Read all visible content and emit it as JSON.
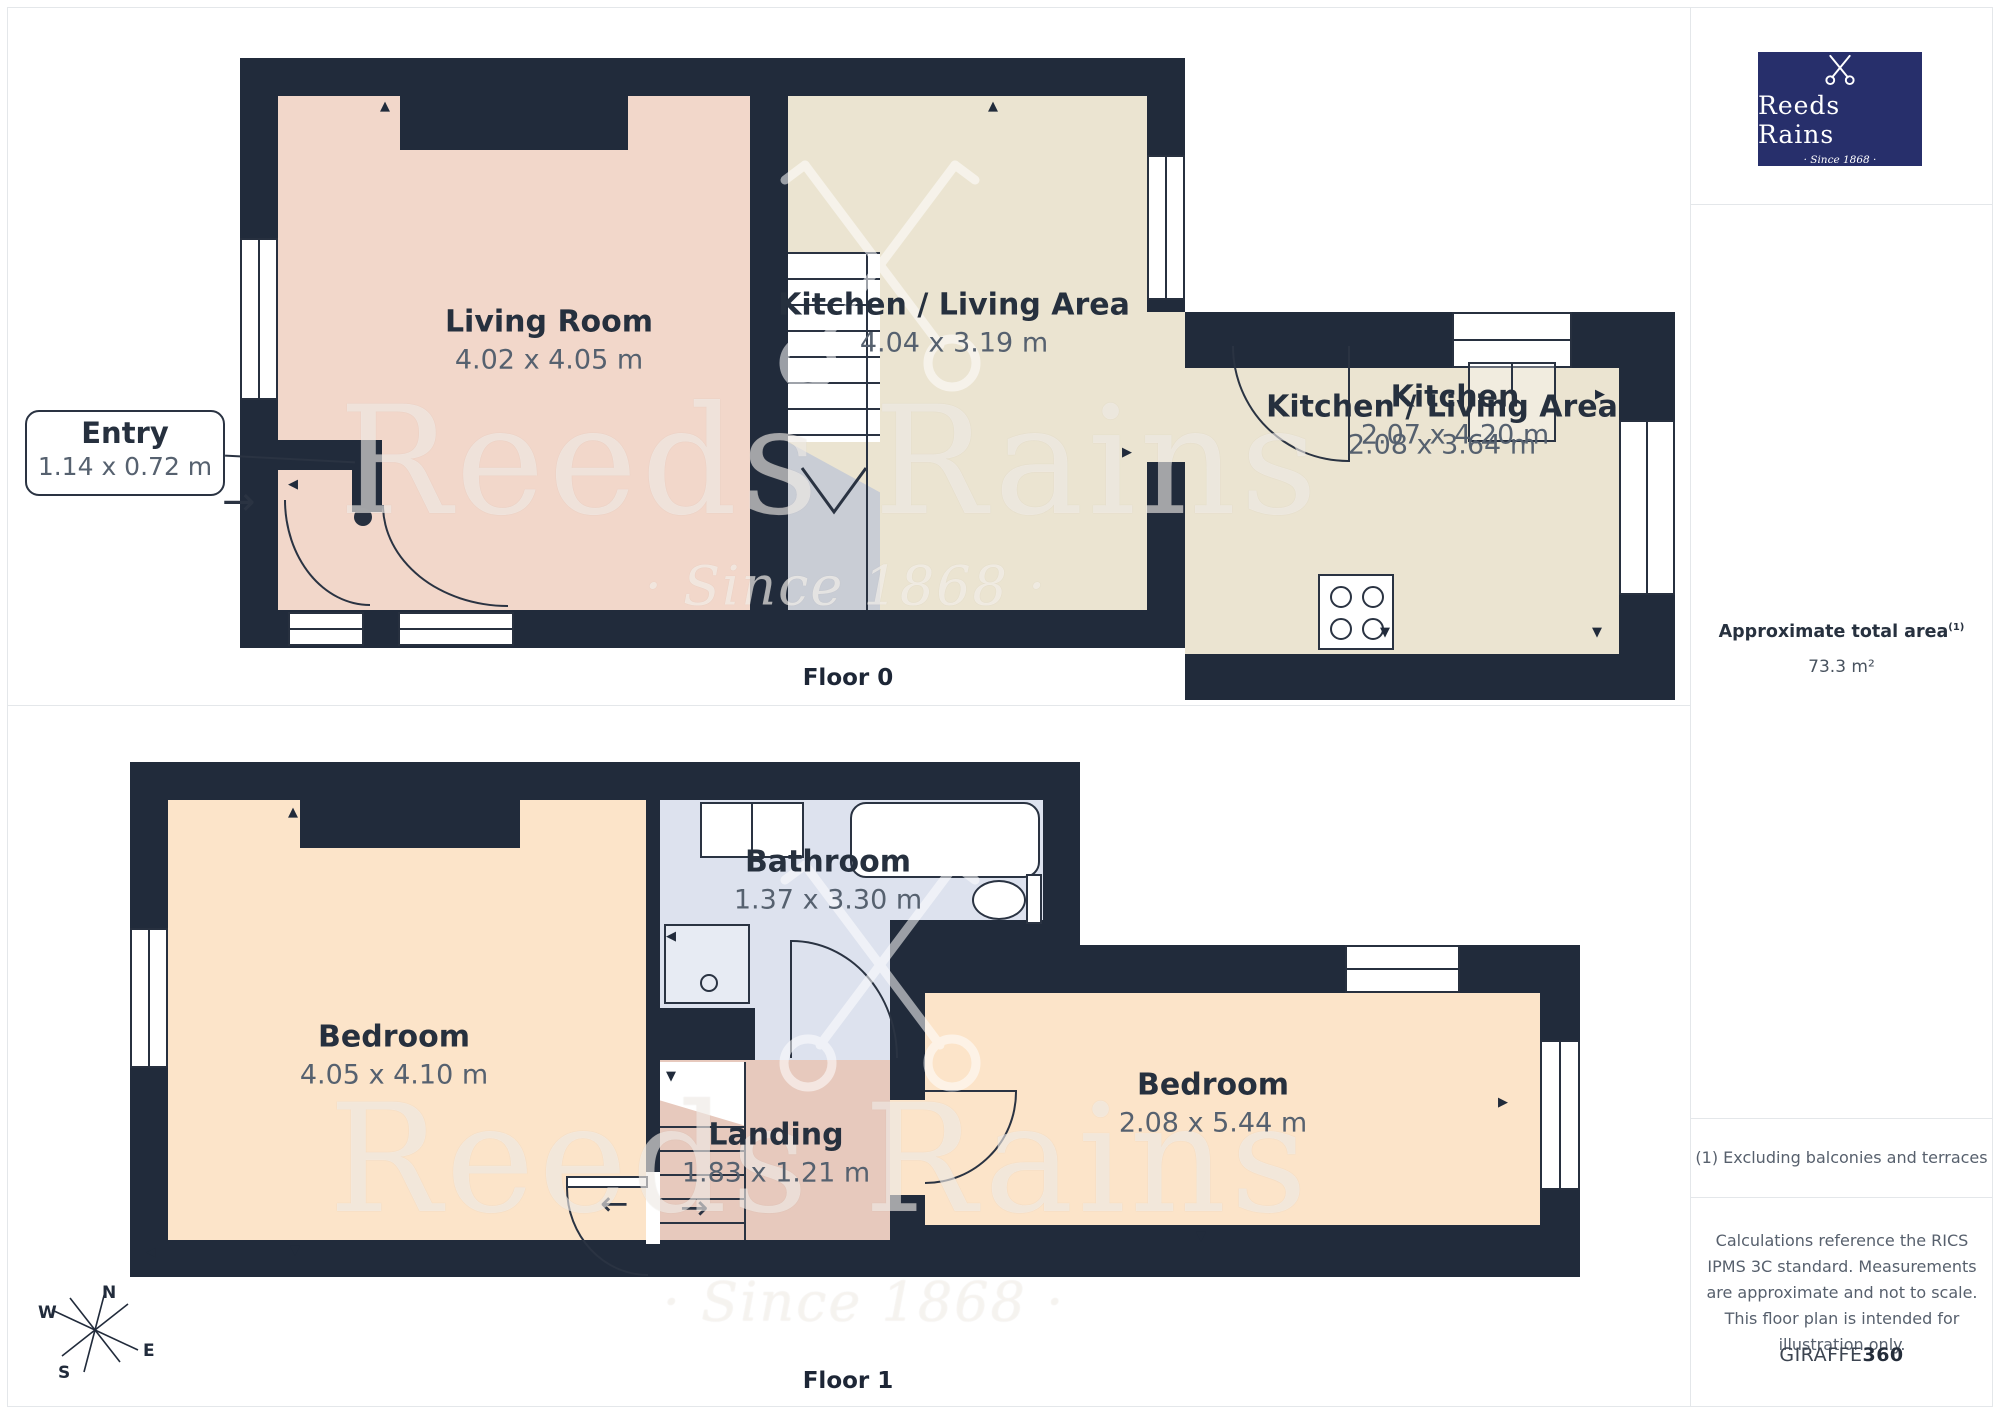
{
  "branding": {
    "logo_title": "Reeds Rains",
    "logo_tagline": "· Since 1868 ·",
    "logo_bg_color": "#272f6b",
    "watermark_title": "Reeds Rains",
    "watermark_tagline": "· Since 1868 ·"
  },
  "sidebar": {
    "area_heading": "Approximate total area",
    "area_footnote_marker": "(1)",
    "area_value": "73.3 m²",
    "footnote": "(1) Excluding balconies and terraces",
    "disclaimer": "Calculations reference the RICS IPMS 3C standard. Measurements are approximate and not to scale. This floor plan is intended for illustration only.",
    "brand_name": "GIRAFFE",
    "brand_suffix": "360"
  },
  "floor0": {
    "label": "Floor 0",
    "entry": {
      "name": "Entry",
      "dims": "1.14 x 0.72 m"
    },
    "rooms": [
      {
        "name": "Living Room",
        "dims": "4.02 x 4.05 m"
      },
      {
        "name": "Kitchen / Living Area",
        "dims": "4.04 x 3.19 m"
      },
      {
        "name": "Kitchen",
        "dims": "2.07 x 4.20 m"
      },
      {
        "name": "Kitchen / Living Area",
        "dims": "2.08 x 3.64 m"
      }
    ]
  },
  "floor1": {
    "label": "Floor 1",
    "rooms": [
      {
        "name": "Bedroom",
        "dims": "4.05 x 4.10 m"
      },
      {
        "name": "Bathroom",
        "dims": "1.37 x 3.30 m"
      },
      {
        "name": "Landing",
        "dims": "1.83 x 1.21 m"
      },
      {
        "name": "Bedroom",
        "dims": "2.08 x 5.44 m"
      }
    ]
  },
  "compass": {
    "n": "N",
    "e": "E",
    "s": "S",
    "w": "W"
  },
  "icons": {
    "marker_up": "▲",
    "marker_down": "▼",
    "marker_left": "◀",
    "marker_right": "▶",
    "arrow_right": "→",
    "arrow_left": "←"
  },
  "colors": {
    "wall": "#212b3b",
    "living_room_fill": "#f2d7ca",
    "kitchen_fill": "#ebe4d1",
    "bedroom_fill": "#fce4c9",
    "landing_fill": "#e7c9bd",
    "bathroom_fill": "#dde2ee",
    "stairs_gray": "#c9cdd5",
    "logo_navy": "#272f6b",
    "label_text": "#26303e",
    "dims_text": "#56616f"
  }
}
